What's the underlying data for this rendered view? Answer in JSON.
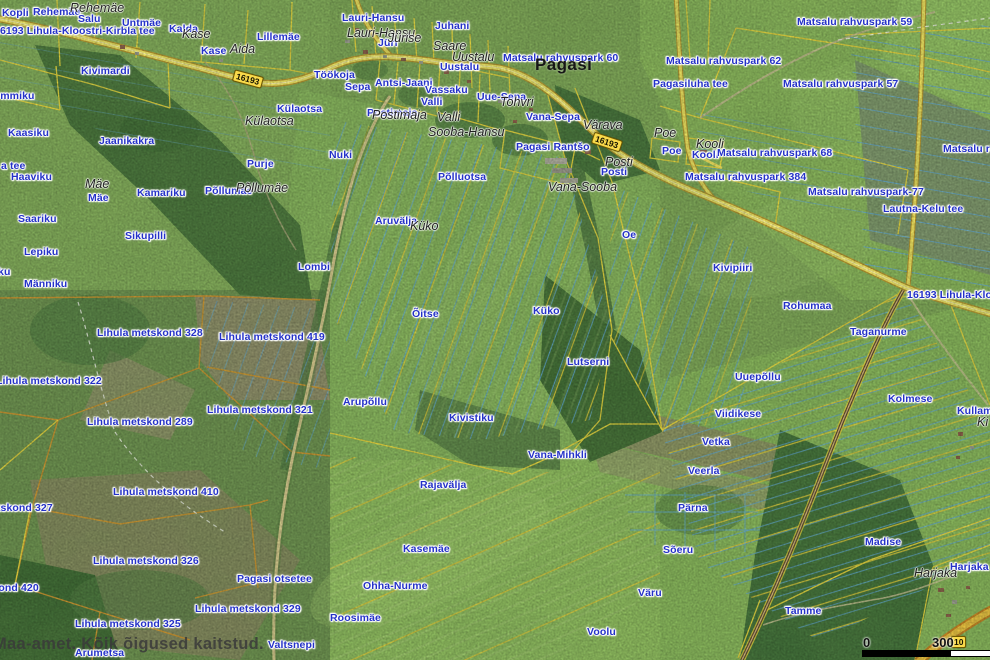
{
  "map": {
    "attribution": "Maa-amet. Kõik õigused kaitstud.",
    "scale_bar": {
      "start_label": "0",
      "end_label": "300"
    },
    "road_badges": [
      {
        "t": "16193",
        "x": 233,
        "y": 73,
        "r": 15
      },
      {
        "t": "16193",
        "x": 592,
        "y": 136,
        "r": 18
      },
      {
        "t": "10",
        "x": 951,
        "y": 636,
        "r": 0
      }
    ],
    "colors": {
      "parcel_label_blue": "#2431c8",
      "boundary_yellow": "#e8d23c",
      "metskond_orange": "#d2952e",
      "ditch_blue": "#5fa9dc",
      "road_yellow": "#f3e35f",
      "badge_yellow": "#f9da4b"
    },
    "labels": {
      "parcel": [
        {
          "t": "Kopli",
          "x": 2,
          "y": 8
        },
        {
          "t": "Rehemäe",
          "x": 33,
          "y": 7
        },
        {
          "t": "Salu",
          "x": 78,
          "y": 14
        },
        {
          "t": "16193 Lihula-Kloostri-Kirbla tee",
          "x": -6,
          "y": 26
        },
        {
          "t": "Untmäe",
          "x": 122,
          "y": 18
        },
        {
          "t": "Kalda",
          "x": 169,
          "y": 24
        },
        {
          "t": "Kase",
          "x": 201,
          "y": 46
        },
        {
          "t": "Lillemäe",
          "x": 257,
          "y": 32
        },
        {
          "t": "Kivimardi",
          "x": 81,
          "y": 66
        },
        {
          "t": "Nõmmiku",
          "x": -14,
          "y": 91
        },
        {
          "t": "Kaasiku",
          "x": 8,
          "y": 128
        },
        {
          "t": "Jaanikakra",
          "x": 99,
          "y": 136
        },
        {
          "t": "a tee",
          "x": 1,
          "y": 161
        },
        {
          "t": "Haaviku",
          "x": 11,
          "y": 172
        },
        {
          "t": "ku",
          "x": -2,
          "y": 267
        },
        {
          "t": "Saariku",
          "x": 18,
          "y": 214
        },
        {
          "t": "Lepiku",
          "x": 24,
          "y": 247
        },
        {
          "t": "Männiku",
          "x": 24,
          "y": 279
        },
        {
          "t": "Sikupilli",
          "x": 125,
          "y": 231
        },
        {
          "t": "Mäe",
          "x": 88,
          "y": 193
        },
        {
          "t": "Kamariku",
          "x": 137,
          "y": 188
        },
        {
          "t": "Põllumäe",
          "x": 205,
          "y": 186
        },
        {
          "t": "Purje",
          "x": 247,
          "y": 159
        },
        {
          "t": "Külaotsa",
          "x": 277,
          "y": 104
        },
        {
          "t": "Lombi",
          "x": 298,
          "y": 262
        },
        {
          "t": "Töökoja",
          "x": 314,
          "y": 70
        },
        {
          "t": "Sepa",
          "x": 345,
          "y": 82
        },
        {
          "t": "Antsi-Jaani",
          "x": 375,
          "y": 78
        },
        {
          "t": "Vassaku",
          "x": 425,
          "y": 85
        },
        {
          "t": "Valli",
          "x": 421,
          "y": 97
        },
        {
          "t": "Postimaja",
          "x": 367,
          "y": 108
        },
        {
          "t": "Uue-Sepa",
          "x": 477,
          "y": 92
        },
        {
          "t": "Lauri-Hansu",
          "x": 342,
          "y": 13
        },
        {
          "t": "Jüri",
          "x": 378,
          "y": 38
        },
        {
          "t": "Juhani",
          "x": 435,
          "y": 21
        },
        {
          "t": "Uustalu",
          "x": 440,
          "y": 62
        },
        {
          "t": "Matsalu rahvuspark 60",
          "x": 503,
          "y": 53
        },
        {
          "t": "Vana-Sepa",
          "x": 526,
          "y": 112
        },
        {
          "t": "Pagasi Rantšo",
          "x": 516,
          "y": 142
        },
        {
          "t": "Posti",
          "x": 601,
          "y": 167
        },
        {
          "t": "Nuki",
          "x": 329,
          "y": 150
        },
        {
          "t": "Põlluotsa",
          "x": 438,
          "y": 172
        },
        {
          "t": "Aruvälja",
          "x": 375,
          "y": 216
        },
        {
          "t": "Oe",
          "x": 622,
          "y": 230
        },
        {
          "t": "Õitse",
          "x": 412,
          "y": 309
        },
        {
          "t": "Küko",
          "x": 533,
          "y": 306
        },
        {
          "t": "Lutserni",
          "x": 567,
          "y": 357
        },
        {
          "t": "Matsalu rahvuspark 62",
          "x": 666,
          "y": 56
        },
        {
          "t": "Pagasiluha tee",
          "x": 653,
          "y": 79
        },
        {
          "t": "Matsalu rahvuspark 59",
          "x": 797,
          "y": 17
        },
        {
          "t": "Matsalu rahvuspark 57",
          "x": 783,
          "y": 79
        },
        {
          "t": "Poe",
          "x": 662,
          "y": 146
        },
        {
          "t": "Kooli",
          "x": 692,
          "y": 150
        },
        {
          "t": "Matsalu rahvuspark 68",
          "x": 717,
          "y": 148
        },
        {
          "t": "Matsalu rahvuspark 384",
          "x": 685,
          "y": 172
        },
        {
          "t": "Matsalu rahvuspark",
          "x": 943,
          "y": 144
        },
        {
          "t": "Matsalu rahvuspark-77",
          "x": 808,
          "y": 187
        },
        {
          "t": "Lautna-Kelu tee",
          "x": 883,
          "y": 204
        },
        {
          "t": "16193 Lihula-Kloostri-Kirbla tee",
          "x": 907,
          "y": 290
        },
        {
          "t": "Kivipiiri",
          "x": 713,
          "y": 263
        },
        {
          "t": "Rohumaa",
          "x": 783,
          "y": 301
        },
        {
          "t": "Taganurme",
          "x": 850,
          "y": 327
        },
        {
          "t": "Uuepõllu",
          "x": 735,
          "y": 372
        },
        {
          "t": "Kolmese",
          "x": 888,
          "y": 394
        },
        {
          "t": "Viidikese",
          "x": 715,
          "y": 409
        },
        {
          "t": "Kullamäe",
          "x": 957,
          "y": 406
        },
        {
          "t": "Vetka",
          "x": 702,
          "y": 437
        },
        {
          "t": "Veerla",
          "x": 688,
          "y": 466
        },
        {
          "t": "Pärna",
          "x": 678,
          "y": 503
        },
        {
          "t": "Sõeru",
          "x": 663,
          "y": 545
        },
        {
          "t": "Madise",
          "x": 865,
          "y": 537
        },
        {
          "t": "Harjaka",
          "x": 950,
          "y": 562
        },
        {
          "t": "Tamme",
          "x": 785,
          "y": 606
        },
        {
          "t": "Lihula metskond 328",
          "x": 97,
          "y": 328
        },
        {
          "t": "Lihula metskond 419",
          "x": 219,
          "y": 332
        },
        {
          "t": "Lihula metskond 322",
          "x": -4,
          "y": 376
        },
        {
          "t": "Lihula metskond 321",
          "x": 207,
          "y": 405
        },
        {
          "t": "Lihula metskond 289",
          "x": 87,
          "y": 417
        },
        {
          "t": "Lihula metskond 410",
          "x": 113,
          "y": 487
        },
        {
          "t": "Lihula metskond 327",
          "x": -53,
          "y": 503
        },
        {
          "t": "Lihula metskond 420",
          "x": -67,
          "y": 583
        },
        {
          "t": "Lihula metskond 326",
          "x": 93,
          "y": 556
        },
        {
          "t": "Pagasi otsetee",
          "x": 237,
          "y": 574
        },
        {
          "t": "Lihula metskond 329",
          "x": 195,
          "y": 604
        },
        {
          "t": "Lihula metskond 325",
          "x": 75,
          "y": 619
        },
        {
          "t": "Arumetsa",
          "x": 75,
          "y": 648
        },
        {
          "t": "Valtsnepi",
          "x": 268,
          "y": 640
        },
        {
          "t": "Arupõllu",
          "x": 343,
          "y": 397
        },
        {
          "t": "Kivistiku",
          "x": 449,
          "y": 413
        },
        {
          "t": "Vana-Mihkli",
          "x": 528,
          "y": 450
        },
        {
          "t": "Rajavälja",
          "x": 420,
          "y": 480
        },
        {
          "t": "Kasemäe",
          "x": 403,
          "y": 544
        },
        {
          "t": "Ohha-Nurme",
          "x": 363,
          "y": 581
        },
        {
          "t": "Roosimäe",
          "x": 330,
          "y": 613
        },
        {
          "t": "Väru",
          "x": 638,
          "y": 588
        },
        {
          "t": "Voolu",
          "x": 587,
          "y": 627
        }
      ],
      "place": [
        {
          "t": "Rehemäe",
          "x": 70,
          "y": 2
        },
        {
          "t": "Kase",
          "x": 182,
          "y": 28
        },
        {
          "t": "Aida",
          "x": 230,
          "y": 43
        },
        {
          "t": "Lauri-Hansu",
          "x": 347,
          "y": 27
        },
        {
          "t": "Jürise",
          "x": 388,
          "y": 32
        },
        {
          "t": "Saare",
          "x": 433,
          "y": 40
        },
        {
          "t": "Uustalu",
          "x": 452,
          "y": 51
        },
        {
          "t": "Postimaja",
          "x": 372,
          "y": 109
        },
        {
          "t": "Valli",
          "x": 437,
          "y": 111
        },
        {
          "t": "Sooba-Hansu",
          "x": 428,
          "y": 126
        },
        {
          "t": "Tohvri",
          "x": 500,
          "y": 96
        },
        {
          "t": "Vana-Sooba",
          "x": 548,
          "y": 181
        },
        {
          "t": "Värava",
          "x": 583,
          "y": 119
        },
        {
          "t": "Posti",
          "x": 605,
          "y": 156
        },
        {
          "t": "Külaotsa",
          "x": 245,
          "y": 115
        },
        {
          "t": "Põllumäe",
          "x": 236,
          "y": 182
        },
        {
          "t": "Mäe",
          "x": 85,
          "y": 178
        },
        {
          "t": "Küko",
          "x": 410,
          "y": 220
        },
        {
          "t": "Poe",
          "x": 654,
          "y": 127
        },
        {
          "t": "Kooli",
          "x": 696,
          "y": 138
        },
        {
          "t": "Harjaka",
          "x": 914,
          "y": 567
        },
        {
          "t": "Ki",
          "x": 977,
          "y": 416
        }
      ],
      "settlement": [
        {
          "t": "Pagasi",
          "x": 535,
          "y": 56
        }
      ]
    }
  }
}
